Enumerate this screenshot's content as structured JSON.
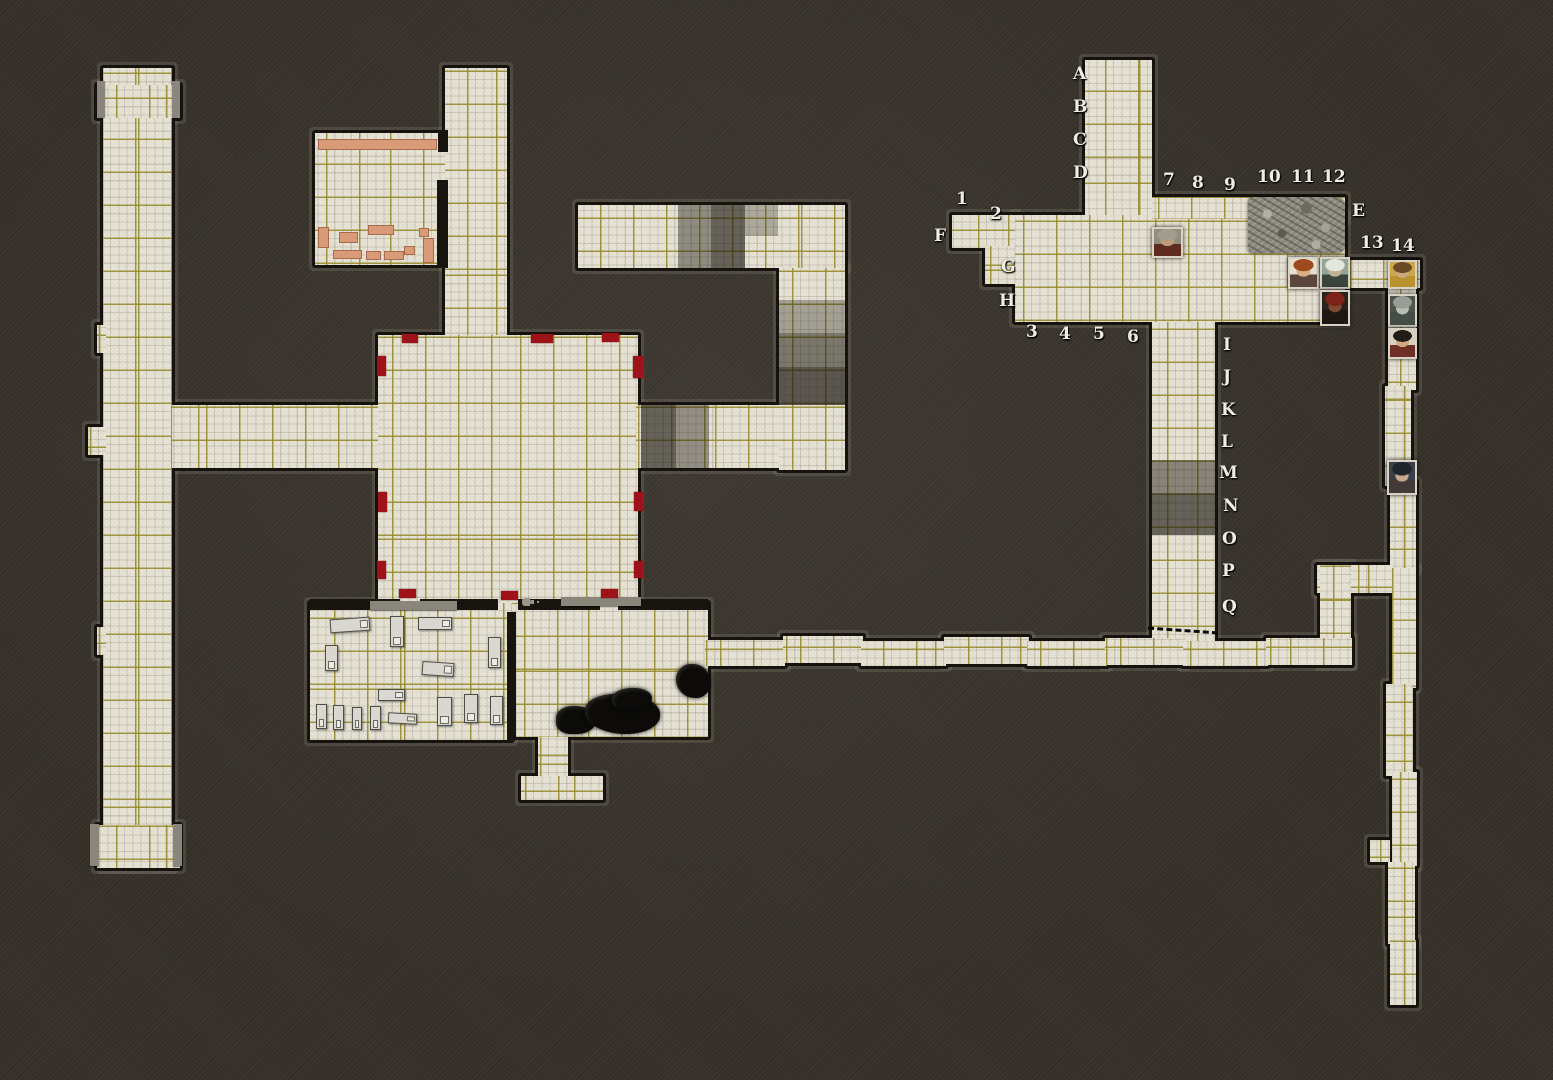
{
  "map": {
    "width": 1553,
    "height": 1080,
    "background_color": "#37322a",
    "tile_color": "#e7e3d6",
    "grid_color": "#968a28",
    "door_marker_color": "#9e1318",
    "furniture_color": "#d99a78",
    "cell_size": 33
  },
  "floors": [
    {
      "x": 103,
      "y": 68,
      "w": 69,
      "h": 800
    },
    {
      "x": 97,
      "y": 85,
      "w": 83,
      "h": 33
    },
    {
      "x": 97,
      "y": 325,
      "w": 9,
      "h": 28
    },
    {
      "x": 97,
      "y": 627,
      "w": 9,
      "h": 28
    },
    {
      "x": 97,
      "y": 825,
      "w": 83,
      "h": 43
    },
    {
      "x": 88,
      "y": 427,
      "w": 18,
      "h": 28
    },
    {
      "x": 172,
      "y": 405,
      "w": 206,
      "h": 63
    },
    {
      "x": 445,
      "y": 68,
      "w": 62,
      "h": 270
    },
    {
      "x": 315,
      "y": 133,
      "w": 130,
      "h": 132
    },
    {
      "x": 378,
      "y": 335,
      "w": 260,
      "h": 268
    },
    {
      "x": 310,
      "y": 603,
      "w": 202,
      "h": 137
    },
    {
      "x": 512,
      "y": 603,
      "w": 196,
      "h": 134
    },
    {
      "x": 538,
      "y": 737,
      "w": 30,
      "h": 42
    },
    {
      "x": 521,
      "y": 776,
      "w": 82,
      "h": 24
    },
    {
      "x": 578,
      "y": 205,
      "w": 267,
      "h": 63
    },
    {
      "x": 779,
      "y": 268,
      "w": 66,
      "h": 202
    },
    {
      "x": 636,
      "y": 405,
      "w": 143,
      "h": 63
    },
    {
      "x": 1085,
      "y": 60,
      "w": 67,
      "h": 158
    },
    {
      "x": 1015,
      "y": 215,
      "w": 330,
      "h": 107
    },
    {
      "x": 1152,
      "y": 197,
      "w": 193,
      "h": 22
    },
    {
      "x": 952,
      "y": 215,
      "w": 63,
      "h": 33
    },
    {
      "x": 985,
      "y": 246,
      "w": 30,
      "h": 38
    },
    {
      "x": 1152,
      "y": 322,
      "w": 63,
      "h": 330
    },
    {
      "x": 1345,
      "y": 260,
      "w": 75,
      "h": 28
    },
    {
      "x": 1388,
      "y": 286,
      "w": 28,
      "h": 104
    },
    {
      "x": 1385,
      "y": 386,
      "w": 26,
      "h": 100
    },
    {
      "x": 1390,
      "y": 482,
      "w": 26,
      "h": 88
    },
    {
      "x": 1317,
      "y": 565,
      "w": 76,
      "h": 28
    },
    {
      "x": 1320,
      "y": 565,
      "w": 31,
      "h": 100
    },
    {
      "x": 1392,
      "y": 568,
      "w": 24,
      "h": 120
    },
    {
      "x": 1386,
      "y": 684,
      "w": 27,
      "h": 92
    },
    {
      "x": 1392,
      "y": 772,
      "w": 25,
      "h": 94
    },
    {
      "x": 1388,
      "y": 862,
      "w": 27,
      "h": 82
    },
    {
      "x": 1390,
      "y": 940,
      "w": 26,
      "h": 65
    },
    {
      "x": 1370,
      "y": 840,
      "w": 20,
      "h": 22
    },
    {
      "x": 705,
      "y": 640,
      "w": 80,
      "h": 26
    },
    {
      "x": 783,
      "y": 636,
      "w": 80,
      "h": 27
    },
    {
      "x": 861,
      "y": 641,
      "w": 85,
      "h": 25
    },
    {
      "x": 944,
      "y": 637,
      "w": 85,
      "h": 27
    },
    {
      "x": 1027,
      "y": 641,
      "w": 80,
      "h": 25
    },
    {
      "x": 1105,
      "y": 638,
      "w": 80,
      "h": 27
    },
    {
      "x": 1183,
      "y": 641,
      "w": 85,
      "h": 25
    },
    {
      "x": 1266,
      "y": 638,
      "w": 86,
      "h": 27
    }
  ],
  "shaded_cells": [
    {
      "x": 678,
      "y": 205,
      "w": 33,
      "h": 63,
      "a": 0.42
    },
    {
      "x": 711,
      "y": 205,
      "w": 34,
      "h": 63,
      "a": 0.62
    },
    {
      "x": 745,
      "y": 205,
      "w": 33,
      "h": 31,
      "a": 0.28
    },
    {
      "x": 779,
      "y": 300,
      "w": 66,
      "h": 33,
      "a": 0.32
    },
    {
      "x": 779,
      "y": 333,
      "w": 66,
      "h": 34,
      "a": 0.52
    },
    {
      "x": 779,
      "y": 367,
      "w": 66,
      "h": 38,
      "a": 0.68
    },
    {
      "x": 641,
      "y": 405,
      "w": 35,
      "h": 63,
      "a": 0.62
    },
    {
      "x": 676,
      "y": 405,
      "w": 33,
      "h": 63,
      "a": 0.4
    },
    {
      "x": 1152,
      "y": 460,
      "w": 63,
      "h": 33,
      "a": 0.45
    },
    {
      "x": 1152,
      "y": 493,
      "w": 63,
      "h": 42,
      "a": 0.62
    }
  ],
  "interior_walls": [
    {
      "x": 310,
      "y": 599,
      "w": 90,
      "h": 11
    },
    {
      "x": 420,
      "y": 599,
      "w": 78,
      "h": 11
    },
    {
      "x": 518,
      "y": 599,
      "w": 82,
      "h": 11
    },
    {
      "x": 618,
      "y": 599,
      "w": 90,
      "h": 11
    },
    {
      "x": 507,
      "y": 612,
      "w": 9,
      "h": 128
    },
    {
      "x": 438,
      "y": 130,
      "w": 10,
      "h": 22
    },
    {
      "x": 437,
      "y": 180,
      "w": 11,
      "h": 88
    }
  ],
  "wall_caps": [
    {
      "x": 370,
      "y": 601,
      "w": 87,
      "h": 9
    },
    {
      "x": 561,
      "y": 597,
      "w": 80,
      "h": 9
    },
    {
      "x": 97,
      "y": 81,
      "w": 8,
      "h": 36
    },
    {
      "x": 172,
      "y": 81,
      "w": 8,
      "h": 36
    },
    {
      "x": 90,
      "y": 824,
      "w": 9,
      "h": 42
    },
    {
      "x": 173,
      "y": 824,
      "w": 9,
      "h": 42
    }
  ],
  "door_markers": [
    {
      "x": 402,
      "y": 334,
      "w": 16,
      "h": 9
    },
    {
      "x": 531,
      "y": 334,
      "w": 22,
      "h": 9
    },
    {
      "x": 602,
      "y": 333,
      "w": 17,
      "h": 9
    },
    {
      "x": 377,
      "y": 356,
      "w": 9,
      "h": 20
    },
    {
      "x": 378,
      "y": 492,
      "w": 9,
      "h": 20
    },
    {
      "x": 377,
      "y": 561,
      "w": 9,
      "h": 18
    },
    {
      "x": 633,
      "y": 356,
      "w": 10,
      "h": 22
    },
    {
      "x": 634,
      "y": 492,
      "w": 9,
      "h": 19
    },
    {
      "x": 634,
      "y": 561,
      "w": 9,
      "h": 17
    },
    {
      "x": 399,
      "y": 589,
      "w": 17,
      "h": 9
    },
    {
      "x": 501,
      "y": 591,
      "w": 17,
      "h": 9
    },
    {
      "x": 601,
      "y": 589,
      "w": 17,
      "h": 9
    }
  ],
  "beds": [
    {
      "x": 330,
      "y": 618,
      "w": 40,
      "h": 14,
      "rot": -4
    },
    {
      "x": 390,
      "y": 616,
      "w": 14,
      "h": 31,
      "rot": 0
    },
    {
      "x": 418,
      "y": 617,
      "w": 34,
      "h": 13,
      "rot": 0
    },
    {
      "x": 325,
      "y": 645,
      "w": 13,
      "h": 26,
      "rot": 0
    },
    {
      "x": 488,
      "y": 637,
      "w": 13,
      "h": 31,
      "rot": 0
    },
    {
      "x": 422,
      "y": 662,
      "w": 32,
      "h": 14,
      "rot": 4
    },
    {
      "x": 378,
      "y": 689,
      "w": 27,
      "h": 12,
      "rot": 0
    },
    {
      "x": 437,
      "y": 697,
      "w": 15,
      "h": 29,
      "rot": 0
    },
    {
      "x": 464,
      "y": 694,
      "w": 14,
      "h": 29,
      "rot": 0
    },
    {
      "x": 490,
      "y": 696,
      "w": 13,
      "h": 29,
      "rot": 0
    },
    {
      "x": 316,
      "y": 704,
      "w": 11,
      "h": 25,
      "rot": 0
    },
    {
      "x": 333,
      "y": 705,
      "w": 11,
      "h": 25,
      "rot": 0
    },
    {
      "x": 352,
      "y": 707,
      "w": 10,
      "h": 23,
      "rot": 0
    },
    {
      "x": 370,
      "y": 706,
      "w": 11,
      "h": 24,
      "rot": 0
    },
    {
      "x": 388,
      "y": 713,
      "w": 29,
      "h": 11,
      "rot": 3
    }
  ],
  "salmon_furniture": [
    {
      "x": 318,
      "y": 139,
      "w": 119,
      "h": 11
    },
    {
      "x": 318,
      "y": 227,
      "w": 11,
      "h": 21
    },
    {
      "x": 339,
      "y": 232,
      "w": 19,
      "h": 11
    },
    {
      "x": 368,
      "y": 225,
      "w": 26,
      "h": 10
    },
    {
      "x": 333,
      "y": 250,
      "w": 29,
      "h": 9
    },
    {
      "x": 366,
      "y": 251,
      "w": 15,
      "h": 9
    },
    {
      "x": 384,
      "y": 251,
      "w": 20,
      "h": 9
    },
    {
      "x": 404,
      "y": 246,
      "w": 11,
      "h": 9
    },
    {
      "x": 419,
      "y": 228,
      "w": 10,
      "h": 9
    },
    {
      "x": 423,
      "y": 238,
      "w": 11,
      "h": 25
    }
  ],
  "coal_piles": [
    {
      "x": 556,
      "y": 706,
      "w": 40,
      "h": 28,
      "r": "45% 55% 50% 40%"
    },
    {
      "x": 585,
      "y": 694,
      "w": 75,
      "h": 40,
      "r": "40% 50% 45% 55%"
    },
    {
      "x": 612,
      "y": 688,
      "w": 40,
      "h": 22,
      "r": "50% 45% 55% 40%"
    },
    {
      "x": 676,
      "y": 664,
      "w": 34,
      "h": 34,
      "r": "45% 50% 40% 55%"
    }
  ],
  "rubble_pile": {
    "x": 1248,
    "y": 197,
    "w": 97,
    "h": 56
  },
  "key_marker": {
    "x": 522,
    "y": 598,
    "w": 8,
    "h": 8
  },
  "dashed_door": {
    "x": 1148,
    "y": 629,
    "w": 70,
    "rot": 4
  },
  "grid_labels": [
    {
      "t": "A",
      "x": 1073,
      "y": 66
    },
    {
      "t": "B",
      "x": 1073,
      "y": 99
    },
    {
      "t": "C",
      "x": 1073,
      "y": 132
    },
    {
      "t": "D",
      "x": 1073,
      "y": 165
    },
    {
      "t": "E",
      "x": 1352,
      "y": 203
    },
    {
      "t": "F",
      "x": 934,
      "y": 228
    },
    {
      "t": "G",
      "x": 1001,
      "y": 259
    },
    {
      "t": "H",
      "x": 999,
      "y": 293
    },
    {
      "t": "I",
      "x": 1223,
      "y": 337
    },
    {
      "t": "J",
      "x": 1223,
      "y": 369
    },
    {
      "t": "K",
      "x": 1221,
      "y": 402
    },
    {
      "t": "L",
      "x": 1221,
      "y": 434
    },
    {
      "t": "M",
      "x": 1219,
      "y": 465
    },
    {
      "t": "N",
      "x": 1223,
      "y": 498
    },
    {
      "t": "O",
      "x": 1222,
      "y": 531
    },
    {
      "t": "P",
      "x": 1222,
      "y": 563
    },
    {
      "t": "Q",
      "x": 1222,
      "y": 599
    },
    {
      "t": "1",
      "x": 956,
      "y": 191
    },
    {
      "t": "2",
      "x": 990,
      "y": 206
    },
    {
      "t": "3",
      "x": 1026,
      "y": 324
    },
    {
      "t": "4",
      "x": 1059,
      "y": 326
    },
    {
      "t": "5",
      "x": 1093,
      "y": 326
    },
    {
      "t": "6",
      "x": 1127,
      "y": 329
    },
    {
      "t": "7",
      "x": 1163,
      "y": 172
    },
    {
      "t": "8",
      "x": 1192,
      "y": 175
    },
    {
      "t": "9",
      "x": 1224,
      "y": 177
    },
    {
      "t": "10",
      "x": 1257,
      "y": 169
    },
    {
      "t": "11",
      "x": 1291,
      "y": 169
    },
    {
      "t": "12",
      "x": 1322,
      "y": 169
    },
    {
      "t": "13",
      "x": 1360,
      "y": 235
    },
    {
      "t": "14",
      "x": 1391,
      "y": 238
    }
  ],
  "tokens": [
    {
      "name": "bald-monk-token",
      "x": 1152,
      "y": 227,
      "w": 31,
      "h": 31,
      "bg": "#8f8d7c",
      "hair": "#a39c8d",
      "face": "#c09b78",
      "cloth": "#5e2b20"
    },
    {
      "name": "red-haired-man-token",
      "x": 1288,
      "y": 257,
      "w": 31,
      "h": 32,
      "bg": "#e6e0cf",
      "hair": "#9c4a1e",
      "face": "#d9af85",
      "cloth": "#5a463a"
    },
    {
      "name": "white-bearded-warrior-token",
      "x": 1320,
      "y": 257,
      "w": 30,
      "h": 32,
      "bg": "#94a496",
      "hair": "#e3e6dd",
      "face": "#c2b096",
      "cloth": "#39453d"
    },
    {
      "name": "red-helmed-warrior-token",
      "x": 1320,
      "y": 290,
      "w": 30,
      "h": 36,
      "bg": "#2a231c",
      "hair": "#7e2318",
      "face": "#7e4a34",
      "cloth": "#1d1814"
    },
    {
      "name": "gold-armored-man-token",
      "x": 1388,
      "y": 260,
      "w": 29,
      "h": 29,
      "bg": "#c9a84c",
      "hair": "#6b4a26",
      "face": "#caa87e",
      "cloth": "#b8922f"
    },
    {
      "name": "gray-skulled-warrior-token",
      "x": 1388,
      "y": 294,
      "w": 29,
      "h": 33,
      "bg": "#4e544e",
      "hair": "#979e95",
      "face": "#b9bdb2",
      "cloth": "#454d47"
    },
    {
      "name": "dark-haired-man-token",
      "x": 1388,
      "y": 328,
      "w": 29,
      "h": 31,
      "bg": "#d6d0c0",
      "hair": "#221c16",
      "face": "#d3a87e",
      "cloth": "#6e2f26"
    },
    {
      "name": "hooded-woman-token",
      "x": 1387,
      "y": 460,
      "w": 30,
      "h": 35,
      "bg": "#39404a",
      "hair": "#20252b",
      "face": "#c7a88c",
      "cloth": "#423a38"
    }
  ]
}
